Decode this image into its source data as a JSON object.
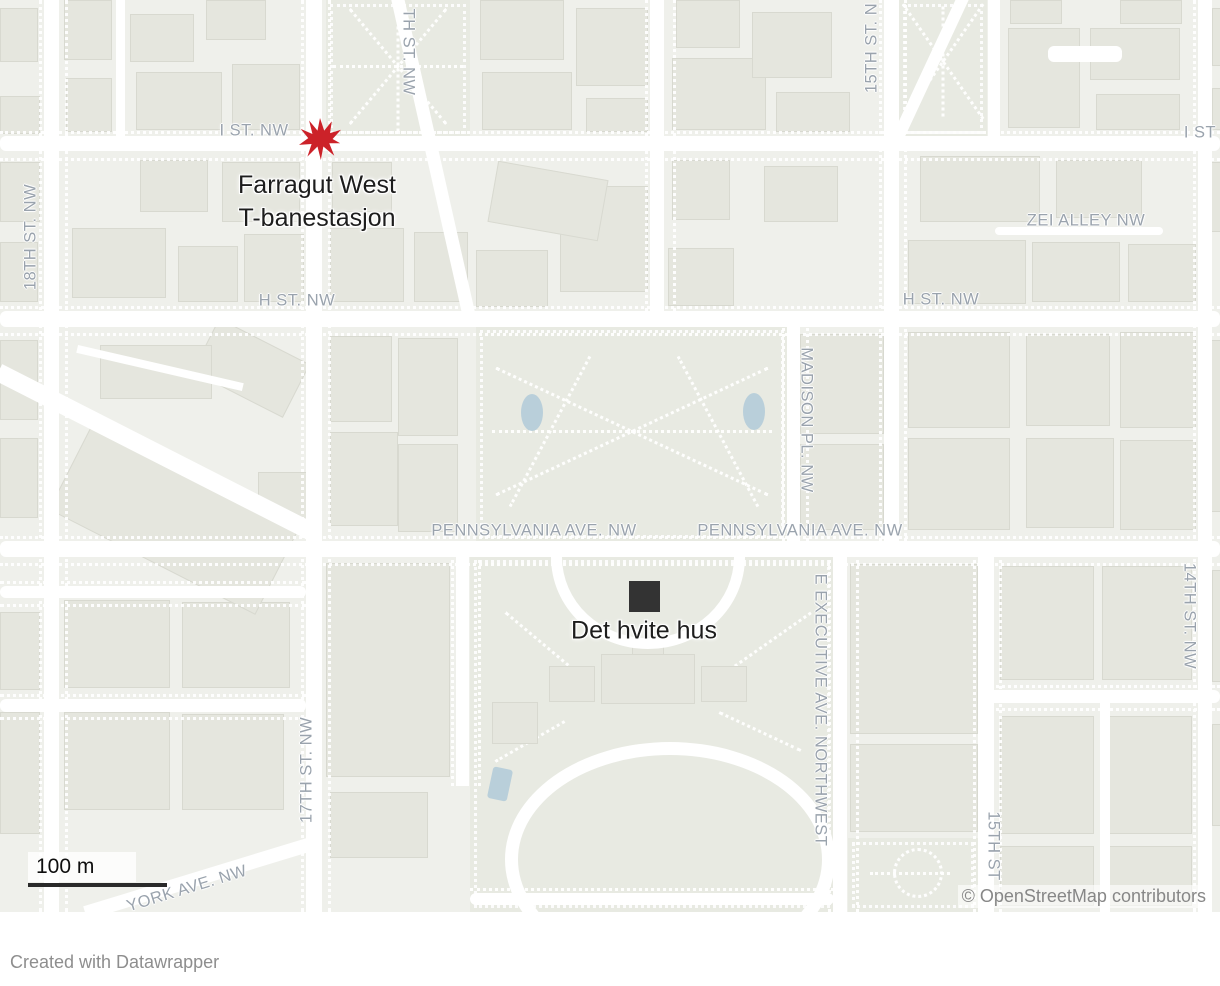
{
  "map": {
    "attribution": "© OpenStreetMap contributors",
    "scale_label": "100 m",
    "street_labels": {
      "i_st_nw": "I ST. NW",
      "eighteenth_st_nw": "18TH ST. NW",
      "seventeenth_st_nw_top": "TH ST. NW",
      "fifteenth_st_n": "15TH ST. N",
      "i_st_right": "I ST",
      "zei_alley_nw": "ZEI ALLEY NW",
      "h_st_nw_west": "H ST. NW",
      "h_st_nw_east": "H ST. NW",
      "madison_pl_nw": "MADISON PL. NW",
      "pennsylvania_ave_nw_west": "PENNSYLVANIA AVE. NW",
      "pennsylvania_ave_nw_east": "PENNSYLVANIA AVE. NW",
      "e_executive_ave_northwest": "E EXECUTIVE AVE. NORTHWEST",
      "fourteenth_st_nw": "14TH ST. NW",
      "seventeenth_st_nw_bottom": "17TH ST. NW",
      "fifteenth_st_bottom": "15TH ST",
      "york_ave_nw": "YORK AVE. NW"
    },
    "markers": {
      "farragut_west": {
        "label_line1": "Farragut West",
        "label_line2": "T-banestasjon",
        "color": "#cc2229"
      },
      "white_house": {
        "label": "Det hvite hus",
        "color": "#333333"
      }
    },
    "colors": {
      "land": "#eff0eb",
      "building": "#e5e6de",
      "park": "#e8eae2",
      "water": "#b9cfda",
      "road": "#ffffff",
      "street_label": "#9aa3ad"
    }
  },
  "footer": {
    "credit": "Created with Datawrapper"
  }
}
